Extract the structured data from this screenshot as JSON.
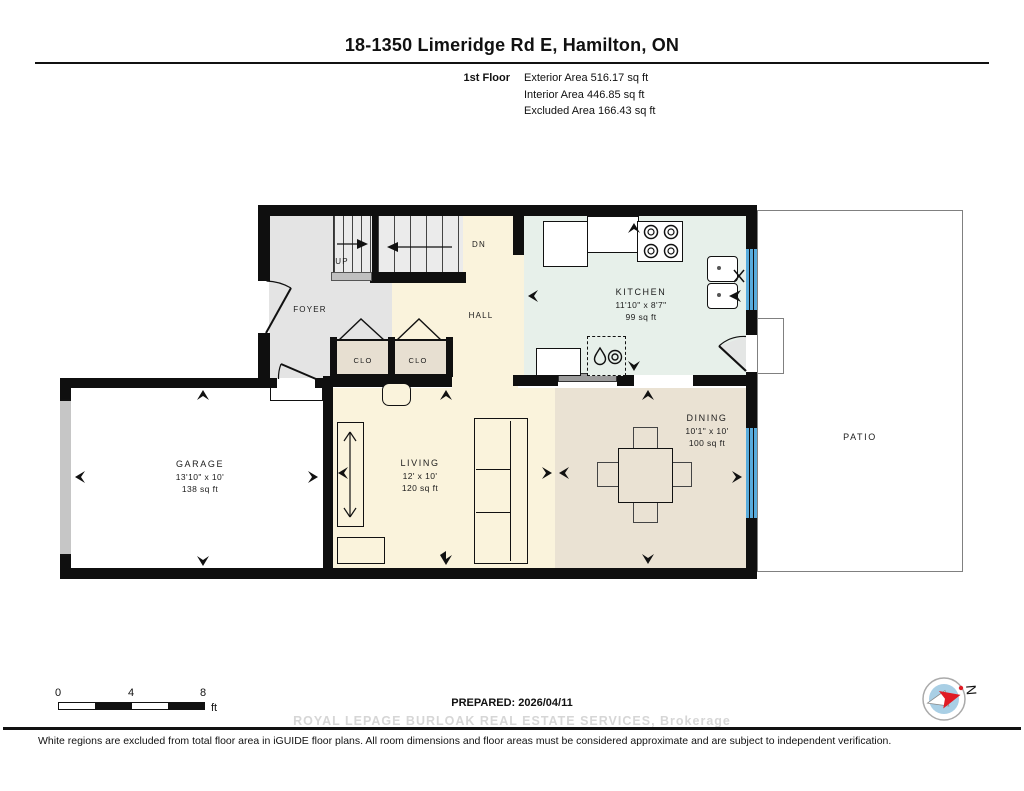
{
  "header": {
    "title": "18-1350 Limeridge Rd E, Hamilton, ON",
    "floor_label": "1st Floor",
    "stats": [
      "Exterior Area 516.17 sq ft",
      "Interior Area 446.85 sq ft",
      "Excluded Area 166.43 sq ft"
    ]
  },
  "rooms": {
    "foyer": {
      "name": "FOYER"
    },
    "hall": {
      "name": "HALL"
    },
    "stairs_up": {
      "label": "UP"
    },
    "stairs_dn": {
      "label": "DN"
    },
    "closet1": {
      "name": "CLO"
    },
    "closet2": {
      "name": "CLO"
    },
    "kitchen": {
      "name": "KITCHEN",
      "dims": "11'10\" x 8'7\"",
      "area": "99 sq ft"
    },
    "garage": {
      "name": "GARAGE",
      "dims": "13'10\" x 10'",
      "area": "138 sq ft"
    },
    "living": {
      "name": "LIVING",
      "dims": "12' x 10'",
      "area": "120 sq ft"
    },
    "dining": {
      "name": "DINING",
      "dims": "10'1\" x 10'",
      "area": "100 sq ft"
    },
    "patio": {
      "name": "PATIO"
    }
  },
  "footer": {
    "scale": {
      "ticks": [
        "0",
        "4",
        "8"
      ],
      "unit": "ft"
    },
    "prepared": "PREPARED: 2026/04/11",
    "compass_north": "N",
    "watermark": "ROYAL LEPAGE BURLOAK REAL ESTATE SERVICES, Brokerage",
    "disclaimer": "White regions are excluded from total floor area in iGUIDE floor plans. All room dimensions and floor areas must be considered approximate and are subject to independent verification."
  },
  "colors": {
    "wall": "#0f0f0f",
    "window_blue": "#58abdc",
    "cream_floor": "#faf3dc",
    "kitchen_mint": "#e7f0ea",
    "dining_tan": "#eae2d3",
    "closet_tan": "#e7dfd1",
    "foyer_gray": "#e4e4e4",
    "garage_white": "#ffffff",
    "half_wall_gray": "#9c9c9c",
    "garage_door_gray": "#c6c6c6",
    "patio_outline": "#808080",
    "compass_blue": "#a9cfe5",
    "compass_red": "#e01b24",
    "watermark_gray": "#d6d6d6"
  }
}
